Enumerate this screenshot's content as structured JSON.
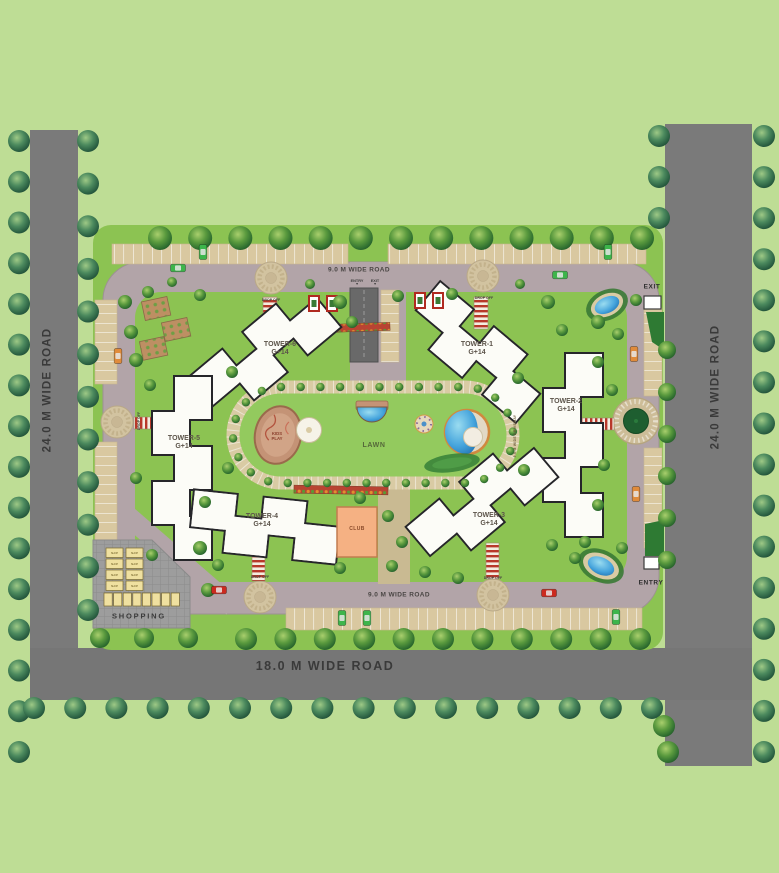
{
  "plan": {
    "roads": {
      "left_vertical": "24.0 M WIDE ROAD",
      "right_vertical": "24.0 M WIDE ROAD",
      "bottom_horizontal": "18.0 M WIDE ROAD",
      "inner_top": "9.0 M WIDE ROAD",
      "inner_bottom": "9.0 M WIDE ROAD",
      "inner_driveway": "9.0 M WIDE DRIVEWAY"
    },
    "towers": [
      {
        "name": "TOWER-1",
        "floors": "G+14"
      },
      {
        "name": "TOWER-2",
        "floors": "G+14"
      },
      {
        "name": "TOWER-3",
        "floors": "G+14"
      },
      {
        "name": "TOWER-4",
        "floors": "G+14"
      },
      {
        "name": "TOWER-5",
        "floors": "G+14"
      },
      {
        "name": "TOWER-6",
        "floors": "G+14"
      }
    ],
    "amenities": {
      "lawn": "LAWN",
      "kids_play": "KIDS PLAY",
      "club": "CLUB",
      "shopping": "SHOPPING",
      "shop_unit": "SHOP"
    },
    "gates": {
      "exit": "EXIT",
      "entry": "ENTRY",
      "basement_entry": "ENTRY",
      "basement_exit": "EXIT"
    },
    "drop_off": "DROP OFF",
    "icons": {
      "ramp_down_arrow": "▼"
    },
    "colors": {
      "background": "#bedd95",
      "outer_road": "#7a7a7a",
      "inner_road": "#b2a4a8",
      "site_green": "#8cc352",
      "parking_tan": "#d9c8a0",
      "building_white": "#fcfcf7",
      "club_orange": "#f5b183",
      "shop_yellow": "#efe0a0",
      "water_blue": "#44a3dc",
      "tree_dark": "#2d6b2f",
      "track_beige": "#d9cba4",
      "kids_play_brown": "#c49376"
    }
  }
}
